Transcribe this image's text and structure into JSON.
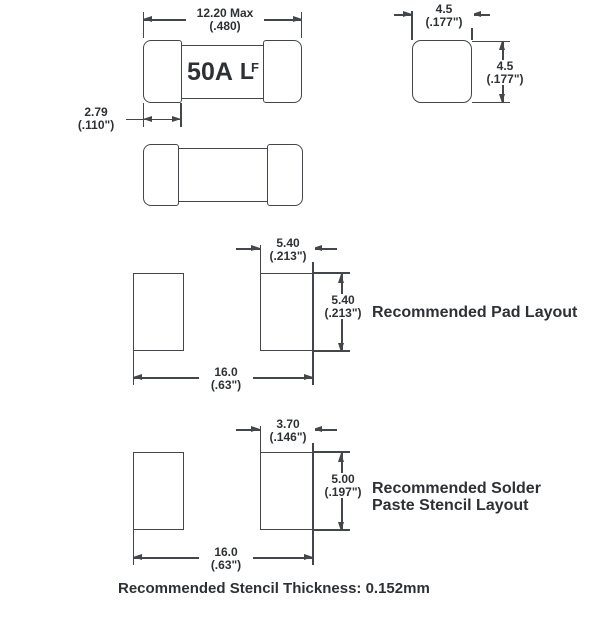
{
  "drawing": {
    "marking": {
      "amperage": "50A",
      "logo": {
        "l": "L",
        "f": "F"
      }
    },
    "dims": {
      "body_length": {
        "value": "12.20 Max",
        "alt": "(.480)"
      },
      "cap_width": {
        "value": "2.79",
        "alt": "(.110\")"
      },
      "end_width": {
        "value": "4.5",
        "alt": "(.177\")"
      },
      "end_height": {
        "value": "4.5",
        "alt": "(.177\")"
      },
      "pad_width": {
        "value": "5.40",
        "alt": "(.213\")"
      },
      "pad_height": {
        "value": "5.40",
        "alt": "(.213\")"
      },
      "pad_span": {
        "value": "16.0",
        "alt": "(.63\")"
      },
      "stencil_width": {
        "value": "3.70",
        "alt": "(.146\")"
      },
      "stencil_height": {
        "value": "5.00",
        "alt": "(.197\")"
      },
      "stencil_span": {
        "value": "16.0",
        "alt": "(.63\")"
      }
    },
    "captions": {
      "pad_layout": "Recommended Pad Layout",
      "stencil_layout_1": "Recommended Solder",
      "stencil_layout_2": "Paste Stencil Layout",
      "stencil_thickness": "Recommended Stencil Thickness: 0.152mm"
    },
    "colors": {
      "line": "#43464a",
      "text": "#2e3134",
      "background": "#ffffff"
    }
  }
}
